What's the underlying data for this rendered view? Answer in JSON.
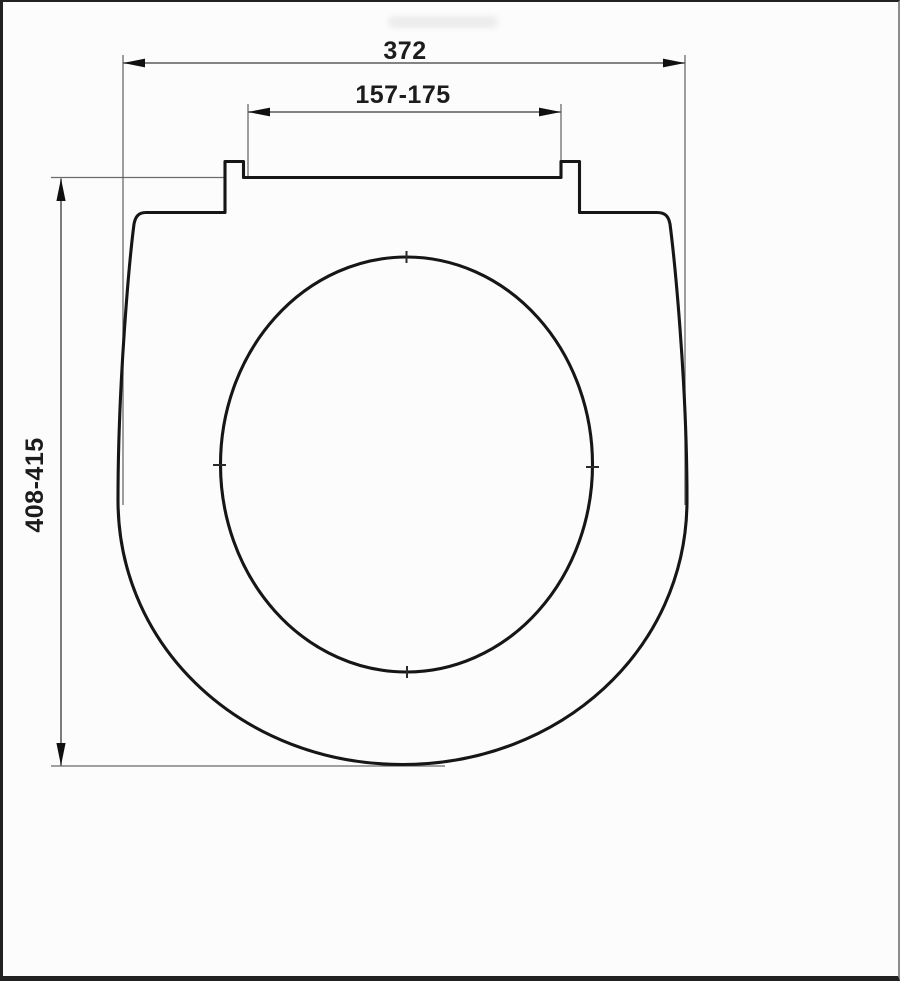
{
  "page": {
    "background": "#fcfcfc",
    "frame_border_color": "#222222"
  },
  "drawing": {
    "kind": "technical-dimension-drawing",
    "labels": {
      "overall_width": "372",
      "hinge_spacing": "157-175",
      "overall_length": "408-415"
    },
    "colors": {
      "outline": "#161616",
      "dimension": "#5b5b5b",
      "arrow": "#101010",
      "text": "#1c1c1c"
    }
  }
}
